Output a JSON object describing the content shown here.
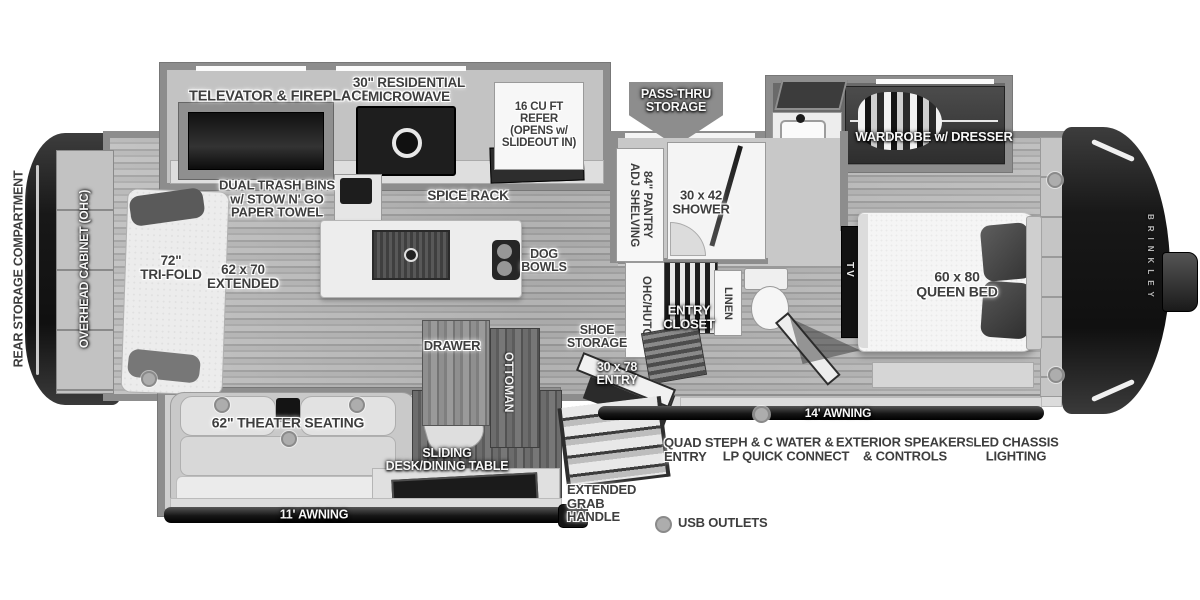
{
  "colors": {
    "background": "#ffffff",
    "wall_gray": "#8d8d8d",
    "floor_gray": "#adadad",
    "fixture_dark": "#2c2c2c",
    "label_dark": "#3e3e3e",
    "label_light": "#f7f7f7",
    "cap_dark": "#1c1c1c",
    "usb_dot": "#adadad"
  },
  "labels": {
    "rear_storage": "REAR STORAGE COMPARTMENT",
    "overhead_cabinet": "OVERHEAD CABINET (OHC)",
    "televator_fireplace": "TELEVATOR & FIREPLACE",
    "residential_microwave": "30\" RESIDENTIAL\nMICROWAVE",
    "refer": "16 CU FT\nREFER\n(OPENS w/\nSLIDEOUT IN)",
    "pass_thru_storage": "PASS-THRU\nSTORAGE",
    "wardrobe_dresser": "WARDROBE w/ DRESSER",
    "dual_trash_bins": "DUAL TRASH BINS\nw/ STOW N' GO\nPAPER TOWEL",
    "spice_rack": "SPICE RACK",
    "tri_fold": "72\"\nTRI-FOLD",
    "extended_62x70": "62 x 70\nEXTENDED",
    "dog_bowls": "DOG\nBOWLS",
    "pantry": "84\" PANTRY\nADJ SHELVING",
    "shower": "30 x 42\nSHOWER",
    "ohc_hutch": "OHC/HUTCH",
    "entry_closet": "ENTRY\nCLOSET",
    "linen": "LINEN",
    "tv": "TV",
    "queen_bed": "60 x 80\nQUEEN BED",
    "drawer": "DRAWER",
    "shoe_storage": "SHOE\nSTORAGE",
    "ottoman": "OTTOMAN",
    "entry_door": "30 x 78\nENTRY",
    "theater_seating": "62\" THEATER SEATING",
    "sliding_desk": "SLIDING\nDESK/DINING TABLE",
    "quad_step": "QUAD STEP\nENTRY",
    "hc_water": "H & C WATER &\nLP QUICK CONNECT",
    "awning_14": "14' AWNING",
    "exterior_speakers": "EXTERIOR SPEAKERS\n& CONTROLS",
    "led_chassis": "LED CHASSIS\nLIGHTING",
    "grab_handle": "EXTENDED\nGRAB\nHANDLE",
    "awning_11": "11' AWNING",
    "usb_outlets": "USB OUTLETS",
    "brand": "BRINKLEY"
  }
}
